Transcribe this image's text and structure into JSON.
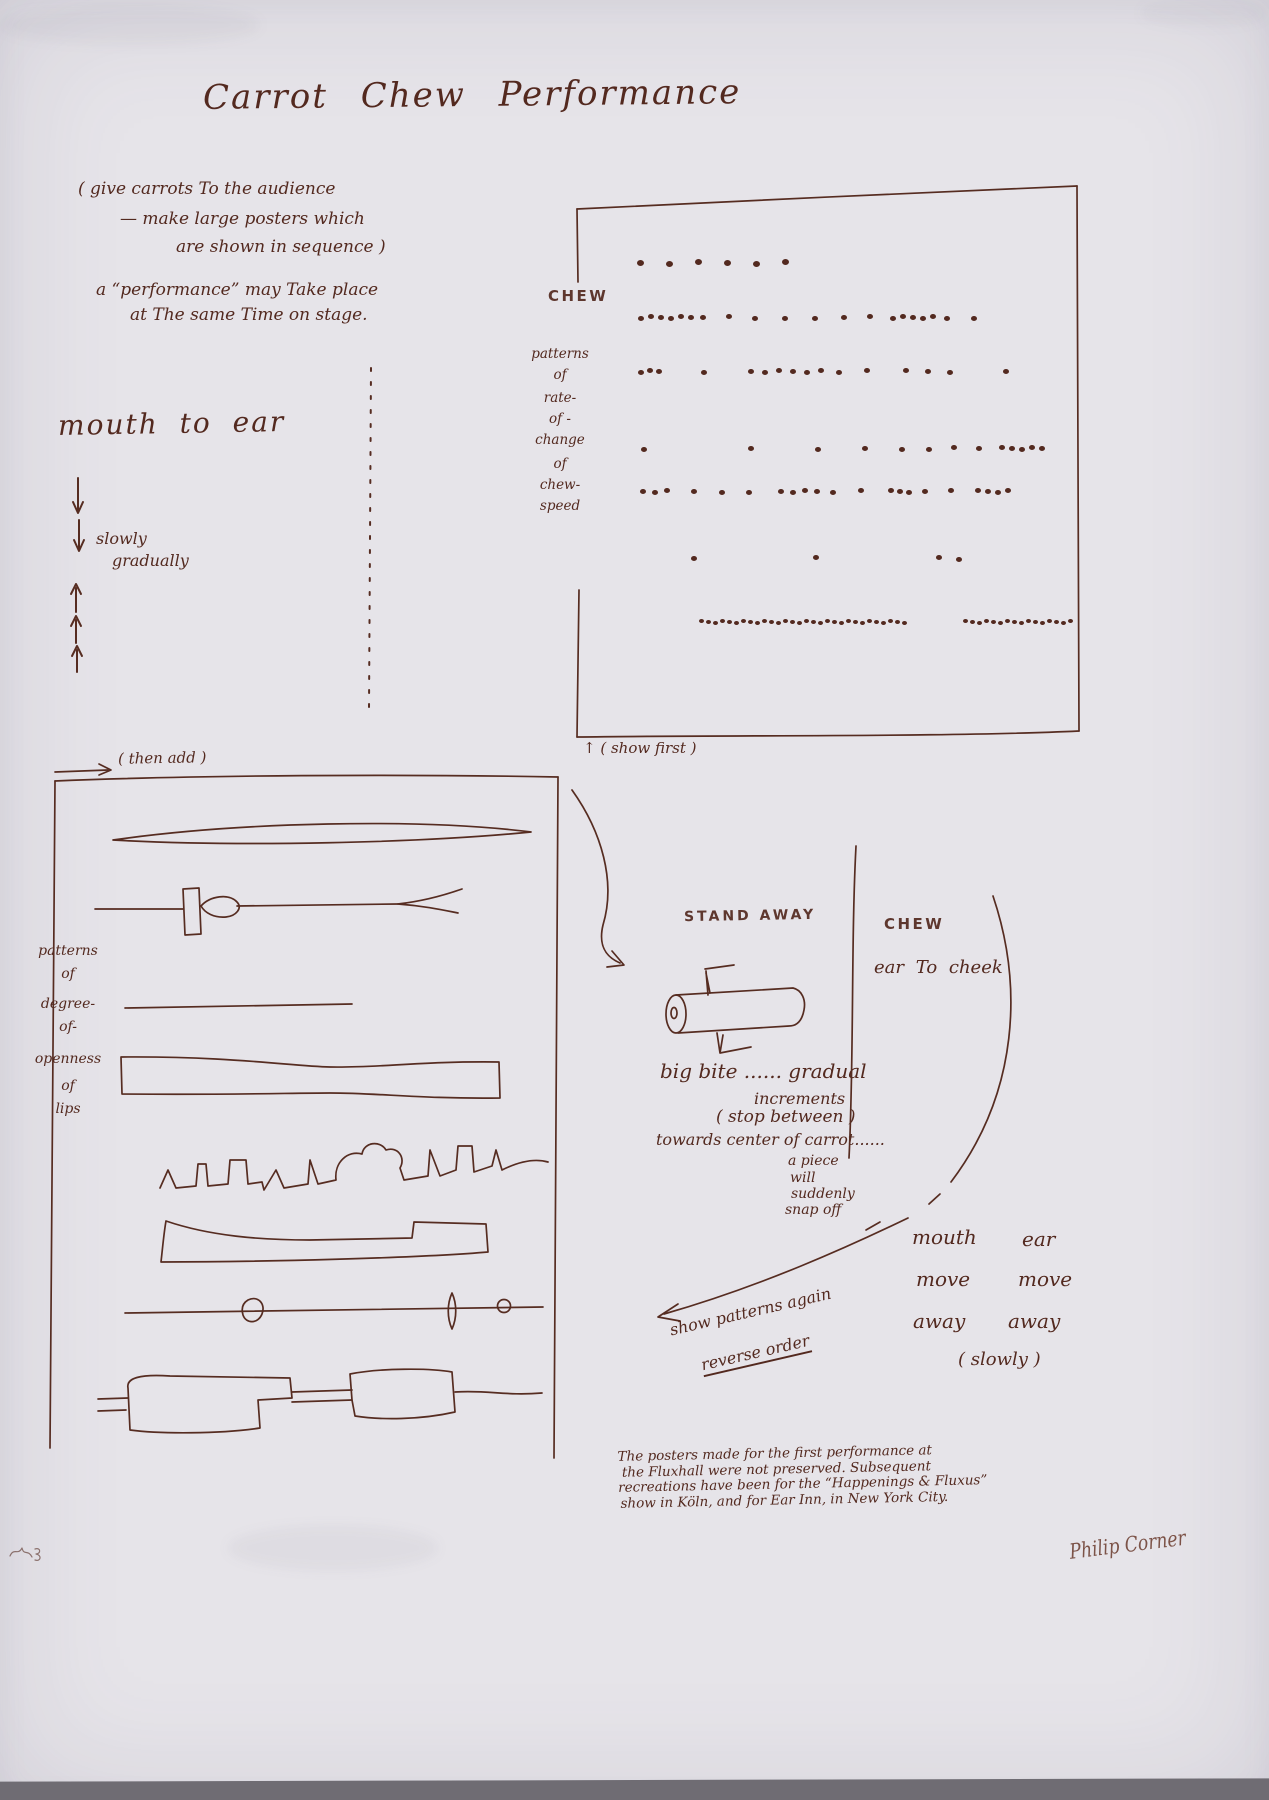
{
  "page": {
    "title": "Carrot Chew Performance"
  },
  "ink_color": "#53291f",
  "paper_color": "#e6e4e9",
  "intro": {
    "l1": "( give carrots To the audience",
    "l2": "— make large posters which",
    "l3": "are shown in sequence )",
    "l4": "a “performance” may Take place",
    "l5": "at The same Time on stage."
  },
  "mouth_to_ear": {
    "heading": "mouth to ear",
    "slowly": "slowly",
    "gradually": "gradually"
  },
  "score_box": {
    "chew_label": "CHEW",
    "side_label_lines": [
      "patterns",
      "of",
      "rate-",
      "of -",
      "change",
      "of",
      "chew-",
      "speed"
    ],
    "show_first": "↑ ( show first )",
    "dot_rows": [
      {
        "y": 260,
        "r": 7,
        "segs": [
          [
            637,
            6,
            29
          ]
        ]
      },
      {
        "y": 315,
        "r": 6,
        "segs": [
          [
            638,
            6,
            10
          ],
          [
            700,
            1,
            0
          ],
          [
            726,
            1,
            0
          ],
          [
            752,
            1,
            0
          ],
          [
            782,
            1,
            0
          ],
          [
            812,
            1,
            0
          ],
          [
            841,
            1,
            0
          ],
          [
            867,
            1,
            0
          ],
          [
            890,
            5,
            10
          ],
          [
            944,
            1,
            0
          ],
          [
            971,
            1,
            0
          ]
        ]
      },
      {
        "y": 369,
        "r": 6,
        "segs": [
          [
            638,
            3,
            9
          ],
          [
            701,
            1,
            0
          ],
          [
            748,
            6,
            14
          ],
          [
            836,
            1,
            0
          ],
          [
            864,
            1,
            0
          ],
          [
            903,
            3,
            22
          ],
          [
            1003,
            1,
            0
          ]
        ]
      },
      {
        "y": 446,
        "r": 6,
        "segs": [
          [
            641,
            1,
            0
          ],
          [
            748,
            1,
            0
          ],
          [
            815,
            1,
            0
          ],
          [
            862,
            1,
            0
          ],
          [
            899,
            1,
            0
          ],
          [
            926,
            1,
            0
          ],
          [
            951,
            1,
            0
          ],
          [
            976,
            1,
            0
          ],
          [
            999,
            5,
            10
          ]
        ]
      },
      {
        "y": 489,
        "r": 6,
        "segs": [
          [
            640,
            3,
            12
          ],
          [
            691,
            1,
            0
          ],
          [
            719,
            1,
            0
          ],
          [
            746,
            1,
            0
          ],
          [
            778,
            4,
            12
          ],
          [
            830,
            1,
            0
          ],
          [
            858,
            1,
            0
          ],
          [
            888,
            3,
            9
          ],
          [
            922,
            1,
            0
          ],
          [
            948,
            1,
            0
          ],
          [
            975,
            4,
            10
          ]
        ]
      },
      {
        "y": 556,
        "r": 6,
        "segs": [
          [
            691,
            1,
            0
          ],
          [
            813,
            1,
            0
          ],
          [
            936,
            1,
            0
          ],
          [
            956,
            1,
            0
          ]
        ]
      },
      {
        "y": 620,
        "r": 5,
        "segs": [
          [
            699,
            30,
            7
          ],
          [
            963,
            16,
            7
          ]
        ]
      }
    ]
  },
  "then_add": "( then add )",
  "lips_box": {
    "side_label_lines": [
      "patterns",
      "of",
      "degree-",
      "of-",
      "openness",
      "of",
      "lips"
    ]
  },
  "stand_away": {
    "label": "STAND AWAY"
  },
  "chew_section": {
    "chew": "CHEW",
    "ear_to_cheek": "ear To cheek"
  },
  "bite_notes": {
    "l1": "big bite ...... gradual",
    "l2": "increments",
    "l3": "( stop between )",
    "l4": "towards center of carrot......",
    "l5": "a piece",
    "l6": "will",
    "l7": "suddenly",
    "l8": "snap off"
  },
  "reverse": {
    "l1": "show patterns again",
    "l2": "reverse order"
  },
  "ending": {
    "c1l1": "mouth",
    "c2l1": "ear",
    "c1l2": "move",
    "c2l2": "move",
    "c1l3": "away",
    "c2l3": "away",
    "slowly": "( slowly )"
  },
  "footnote": {
    "l1": "The posters made for the first performance at",
    "l2": "the Fluxhall were not preserved.  Subsequent",
    "l3": "recreations have been for the “Happenings & Fluxus”",
    "l4": "show in Köln, and for Ear Inn, in New York City."
  },
  "signature": "Philip Corner"
}
